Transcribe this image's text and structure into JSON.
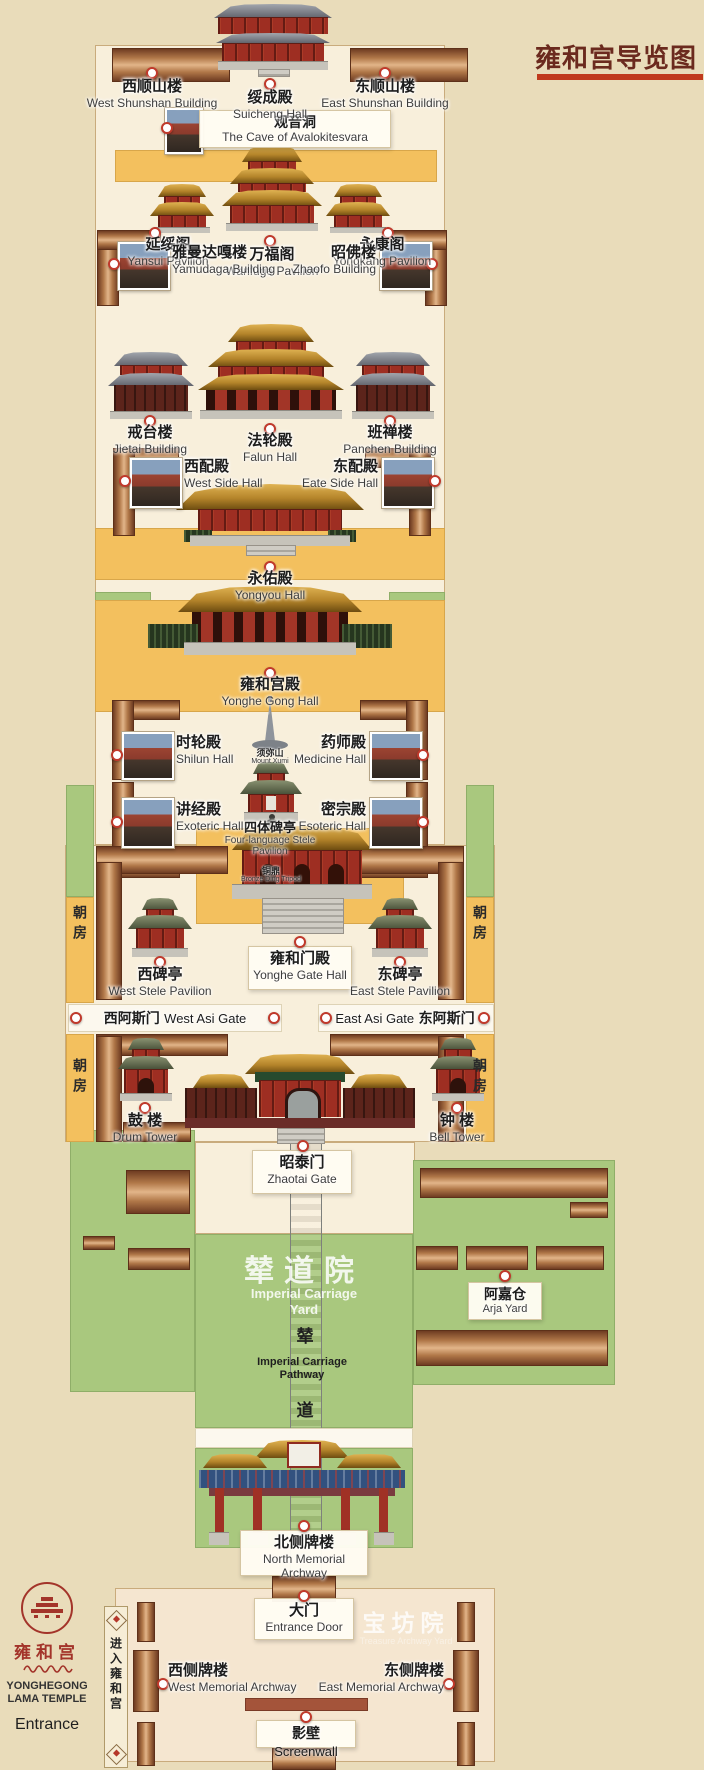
{
  "title": {
    "text": "雍和宫导览图"
  },
  "sites": {
    "west_shunshan": {
      "cn": "西顺山楼",
      "en": "West Shunshan Building"
    },
    "suicheng": {
      "cn": "绥成殿",
      "en": "Suicheng Hall"
    },
    "east_shunshan": {
      "cn": "东顺山楼",
      "en": "East Shunshan Building"
    },
    "guanyin_cave": {
      "cn": "观音洞",
      "en": "The Cave of Avalokitesvara"
    },
    "yansui": {
      "cn": "延绥阁",
      "en": "Yansui Pavilion"
    },
    "wanfuge": {
      "cn": "万福阁",
      "en": "Wanfuge Pavilion"
    },
    "yongkang": {
      "cn": "永康阁",
      "en": "Yongkang Pavilion"
    },
    "yamudaga": {
      "cn": "雅曼达嘎楼",
      "en": "Yamudaga Building"
    },
    "zhaofo": {
      "cn": "昭佛楼",
      "en": "Zhaofo Building"
    },
    "jietai": {
      "cn": "戒台楼",
      "en": "Jietai Building"
    },
    "falun": {
      "cn": "法轮殿",
      "en": "Falun Hall"
    },
    "panchen": {
      "cn": "班禅楼",
      "en": "Panchen Building"
    },
    "west_side_hall": {
      "cn": "西配殿",
      "en": "West Side Hall"
    },
    "east_side_hall": {
      "cn": "东配殿",
      "en": "Eate Side Hall"
    },
    "yongyou": {
      "cn": "永佑殿",
      "en": "Yongyou Hall"
    },
    "yonghegong_hall": {
      "cn": "雍和宫殿",
      "en": "Yonghe Gong Hall"
    },
    "shilun": {
      "cn": "时轮殿",
      "en": "Shilun Hall"
    },
    "medicine": {
      "cn": "药师殿",
      "en": "Medicine Hall"
    },
    "mount_xumi": {
      "cn": "须弥山",
      "en": "Mount Xumi"
    },
    "stele_pavilion": {
      "cn": "四体碑亭",
      "en": "Four-language Stele",
      "en2": "Pavilion"
    },
    "exoteric": {
      "cn": "讲经殿",
      "en": "Exoteric Hall"
    },
    "esoteric": {
      "cn": "密宗殿",
      "en": "Esoteric Hall"
    },
    "bronze_ding": {
      "cn": "铜鼎",
      "en": "Bronze Ding Tripod"
    },
    "yonghe_gate": {
      "cn": "雍和门殿",
      "en": "Yonghe Gate Hall"
    },
    "west_stele": {
      "cn": "西碑亭",
      "en": "West Stele Pavilion"
    },
    "east_stele": {
      "cn": "东碑亭",
      "en": "East Stele Pavilion"
    },
    "west_asi": {
      "cn": "西阿斯门",
      "en": "West Asi Gate"
    },
    "east_asi": {
      "cn": "东阿斯门",
      "en": "East Asi Gate"
    },
    "drum_tower": {
      "cn": "鼓 楼",
      "en": "Drum Tower"
    },
    "bell_tower": {
      "cn": "钟 楼",
      "en": "Bell Tower"
    },
    "zhaotai": {
      "cn": "昭泰门",
      "en": "Zhaotai Gate"
    },
    "arja": {
      "cn": "阿嘉仓",
      "en": "Arja Yard"
    },
    "north_archway": {
      "cn": "北侧牌楼",
      "en": "North Memorial Archway"
    },
    "entrance_door": {
      "cn": "大门",
      "en": "Entrance Door"
    },
    "west_archway": {
      "cn": "西侧牌楼",
      "en": "West Memorial Archway"
    },
    "east_archway": {
      "cn": "东侧牌楼",
      "en": "East Memorial Archway"
    },
    "screenwall": {
      "cn": "影壁",
      "en": "Screenwall"
    }
  },
  "areas": {
    "chaofang": "朝房",
    "carriage_yard": {
      "cn": "辇道院",
      "en1": "Imperial Carriage",
      "en2": "Yard"
    },
    "carriage_path": {
      "cn1": "辇",
      "cn2": "道",
      "en1": "Imperial Carriage",
      "en2": "Pathway"
    },
    "baofang_yard": {
      "cn": "宝坊院",
      "en": "Treasure Archway Yard"
    }
  },
  "logo": {
    "cn": "雍和宫",
    "en1": "YONGHEGONG",
    "en2": "LAMA TEMPLE",
    "entrance": "Entrance",
    "banner": "进入雍和宫",
    "tibetan_icon": "tibetan-script"
  },
  "colors": {
    "background": "#e9dcba",
    "panel": "#f8efdb",
    "walkway_yellow": "#f3c05e",
    "lawn_green": "#a9c87e",
    "roof_brown": "#b5764a",
    "marker_red": "#c0392b",
    "title_text": "#6b2a1e",
    "title_bar": "#c03a1d"
  }
}
